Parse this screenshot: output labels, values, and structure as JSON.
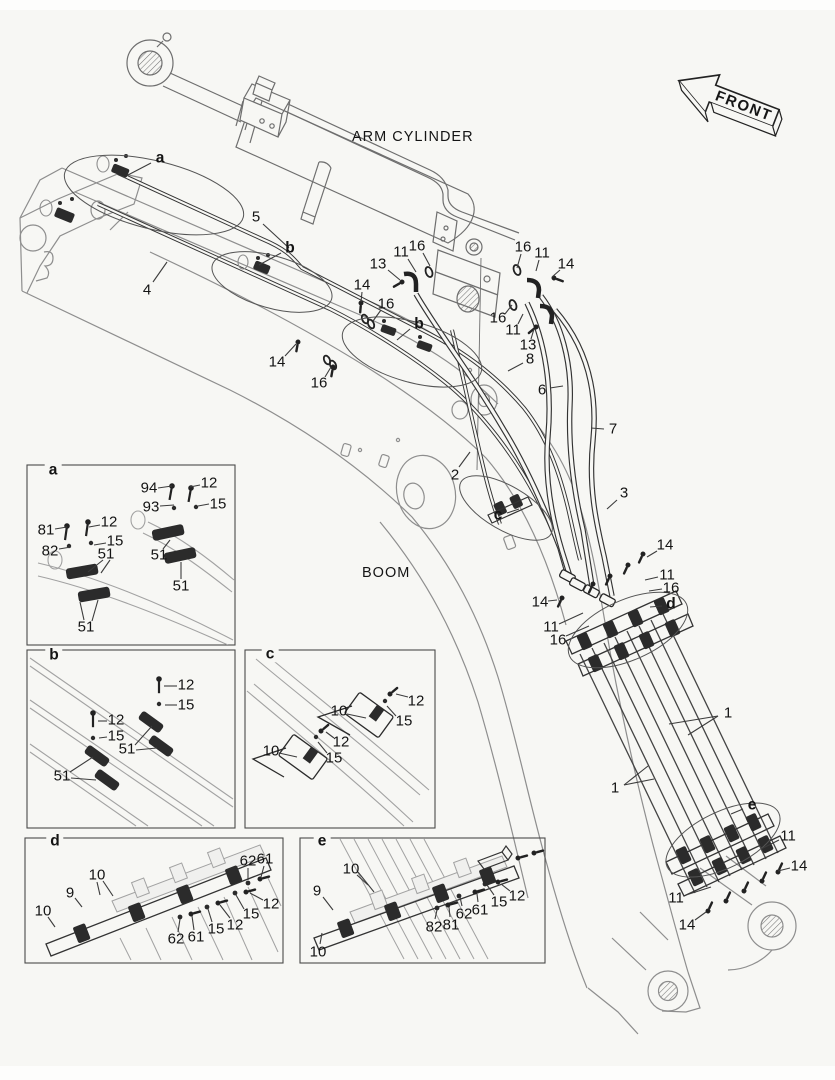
{
  "labels": {
    "arm_cylinder": "ARM CYLINDER",
    "boom": "BOOM",
    "front": "FRONT"
  },
  "colors": {
    "background": "#f7f7f4",
    "line_dark": "#262626",
    "line_structure": "#8e8e8e",
    "text": "#141414"
  },
  "main_callouts": [
    {
      "t": "a",
      "b": 1,
      "x": 160,
      "y": 158,
      "l": [
        [
          151,
          163,
          128,
          175
        ]
      ]
    },
    {
      "t": "5",
      "x": 256,
      "y": 217,
      "l": [
        [
          263,
          224,
          289,
          248
        ]
      ]
    },
    {
      "t": "b",
      "b": 1,
      "x": 290,
      "y": 248,
      "l": [
        [
          281,
          253,
          259,
          265
        ]
      ]
    },
    {
      "t": "4",
      "x": 147,
      "y": 290,
      "l": [
        [
          153,
          282,
          167,
          262
        ]
      ]
    },
    {
      "t": "13",
      "x": 378,
      "y": 264,
      "l": [
        [
          388,
          270,
          400,
          280
        ]
      ]
    },
    {
      "t": "11",
      "x": 401,
      "y": 252,
      "l": [
        [
          408,
          259,
          416,
          272
        ]
      ]
    },
    {
      "t": "16",
      "x": 417,
      "y": 246,
      "l": [
        [
          423,
          253,
          430,
          266
        ]
      ]
    },
    {
      "t": "14",
      "x": 362,
      "y": 285,
      "l": [
        [
          362,
          292,
          361,
          302
        ]
      ]
    },
    {
      "t": "16",
      "x": 386,
      "y": 304,
      "l": [
        [
          381,
          310,
          373,
          321
        ]
      ]
    },
    {
      "t": "b",
      "b": 1,
      "x": 419,
      "y": 324,
      "l": [
        [
          410,
          329,
          397,
          340
        ]
      ]
    },
    {
      "t": "14",
      "x": 277,
      "y": 362,
      "l": [
        [
          285,
          356,
          296,
          344
        ]
      ]
    },
    {
      "t": "16",
      "x": 319,
      "y": 383,
      "l": [
        [
          325,
          377,
          331,
          367
        ]
      ]
    },
    {
      "t": "16",
      "x": 523,
      "y": 247,
      "l": [
        [
          521,
          254,
          517,
          268
        ]
      ]
    },
    {
      "t": "11",
      "x": 542,
      "y": 253,
      "l": [
        [
          539,
          260,
          536,
          271
        ]
      ]
    },
    {
      "t": "14",
      "x": 566,
      "y": 264,
      "l": [
        [
          560,
          270,
          552,
          277
        ]
      ]
    },
    {
      "t": "16",
      "x": 498,
      "y": 318,
      "l": [
        [
          505,
          314,
          512,
          305
        ]
      ]
    },
    {
      "t": "11",
      "x": 513,
      "y": 330,
      "l": [
        [
          518,
          324,
          523,
          314
        ]
      ]
    },
    {
      "t": "13",
      "x": 528,
      "y": 345,
      "l": [
        [
          531,
          339,
          534,
          329
        ]
      ]
    },
    {
      "t": "8",
      "x": 530,
      "y": 359,
      "l": [
        [
          523,
          363,
          508,
          371
        ]
      ]
    },
    {
      "t": "6",
      "x": 542,
      "y": 390,
      "l": [
        [
          550,
          388,
          563,
          386
        ]
      ]
    },
    {
      "t": "7",
      "x": 613,
      "y": 429,
      "l": [
        [
          604,
          429,
          591,
          428
        ]
      ]
    },
    {
      "t": "2",
      "x": 455,
      "y": 475,
      "l": [
        [
          459,
          467,
          470,
          452
        ]
      ]
    },
    {
      "t": "3",
      "x": 624,
      "y": 493,
      "l": [
        [
          617,
          500,
          607,
          509
        ]
      ]
    },
    {
      "t": "c",
      "b": 1,
      "x": 498,
      "y": 515,
      "l": [
        [
          507,
          513,
          519,
          509
        ]
      ]
    },
    {
      "t": "14",
      "x": 665,
      "y": 545,
      "l": [
        [
          657,
          551,
          647,
          557
        ]
      ]
    },
    {
      "t": "11",
      "x": 667,
      "y": 575,
      "l": [
        [
          658,
          577,
          645,
          580
        ]
      ]
    },
    {
      "t": "16",
      "x": 671,
      "y": 588,
      "l": [
        [
          662,
          589,
          649,
          591
        ]
      ]
    },
    {
      "t": "d",
      "b": 1,
      "x": 671,
      "y": 604,
      "l": [
        [
          662,
          606,
          650,
          607
        ]
      ]
    },
    {
      "t": "14",
      "x": 540,
      "y": 602,
      "l": [
        [
          548,
          601,
          557,
          600
        ]
      ]
    },
    {
      "t": "11",
      "x": 551,
      "y": 627,
      "l": [
        [
          559,
          624,
          583,
          613
        ]
      ]
    },
    {
      "t": "16",
      "x": 558,
      "y": 640,
      "l": [
        [
          566,
          636,
          589,
          626
        ]
      ]
    },
    {
      "t": "1",
      "x": 728,
      "y": 713,
      "l": [
        [
          718,
          716,
          669,
          724
        ],
        [
          718,
          716,
          688,
          735
        ]
      ]
    },
    {
      "t": "1",
      "x": 615,
      "y": 788,
      "l": [
        [
          624,
          785,
          654,
          779
        ],
        [
          624,
          785,
          648,
          766
        ]
      ]
    },
    {
      "t": "e",
      "b": 1,
      "x": 752,
      "y": 805,
      "l": [
        [
          743,
          809,
          731,
          814
        ]
      ]
    },
    {
      "t": "11",
      "x": 788,
      "y": 836,
      "l": [
        [
          779,
          840,
          761,
          849
        ]
      ]
    },
    {
      "t": "14",
      "x": 799,
      "y": 866,
      "l": [
        [
          790,
          868,
          778,
          871
        ]
      ]
    },
    {
      "t": "11",
      "x": 676,
      "y": 898,
      "l": [
        [
          686,
          895,
          711,
          887
        ]
      ]
    },
    {
      "t": "14",
      "x": 687,
      "y": 925,
      "l": [
        [
          695,
          920,
          706,
          912
        ]
      ]
    }
  ],
  "detail_boxes": [
    {
      "label": "a",
      "lx": 53,
      "ly": 470,
      "callouts": [
        {
          "t": "94",
          "x": 149,
          "y": 488,
          "l": [
            [
              158,
              488,
              172,
              486
            ]
          ]
        },
        {
          "t": "12",
          "x": 209,
          "y": 483,
          "l": [
            [
              200,
              485,
              190,
              487
            ]
          ]
        },
        {
          "t": "93",
          "x": 151,
          "y": 507,
          "l": [
            [
              160,
              506,
              174,
              505
            ]
          ]
        },
        {
          "t": "15",
          "x": 218,
          "y": 504,
          "l": [
            [
              209,
              504,
              198,
              506
            ]
          ]
        },
        {
          "t": "81",
          "x": 46,
          "y": 530,
          "l": [
            [
              55,
              529,
              67,
              527
            ]
          ]
        },
        {
          "t": "12",
          "x": 109,
          "y": 522,
          "l": [
            [
              100,
              525,
              89,
              527
            ]
          ]
        },
        {
          "t": "82",
          "x": 50,
          "y": 551,
          "l": [
            [
              59,
              549,
              71,
              547
            ]
          ]
        },
        {
          "t": "15",
          "x": 115,
          "y": 541,
          "l": [
            [
              106,
              543,
              94,
              545
            ]
          ]
        },
        {
          "t": "51",
          "x": 106,
          "y": 554,
          "l": [
            [
              103,
              560,
              88,
              572
            ],
            [
              110,
              560,
              101,
              573
            ]
          ]
        },
        {
          "t": "51",
          "x": 159,
          "y": 555,
          "l": [
            [
              163,
              549,
              170,
              540
            ]
          ]
        },
        {
          "t": "51",
          "x": 181,
          "y": 586,
          "l": [
            [
              181,
              579,
              181,
              562
            ]
          ]
        },
        {
          "t": "51",
          "x": 86,
          "y": 627,
          "l": [
            [
              84,
              620,
              80,
              602
            ],
            [
              92,
              621,
              98,
              600
            ]
          ]
        }
      ]
    },
    {
      "label": "b",
      "lx": 54,
      "ly": 655,
      "callouts": [
        {
          "t": "12",
          "x": 186,
          "y": 685,
          "l": [
            [
              177,
              686,
              164,
              686
            ]
          ]
        },
        {
          "t": "15",
          "x": 186,
          "y": 705,
          "l": [
            [
              177,
              705,
              165,
              705
            ]
          ]
        },
        {
          "t": "12",
          "x": 116,
          "y": 720,
          "l": [
            [
              107,
              721,
              98,
              721
            ]
          ]
        },
        {
          "t": "15",
          "x": 116,
          "y": 736,
          "l": [
            [
              107,
              737,
              99,
              738
            ]
          ]
        },
        {
          "t": "51",
          "x": 127,
          "y": 749,
          "l": [
            [
              135,
              745,
              152,
              726
            ],
            [
              136,
              750,
              157,
              748
            ]
          ]
        },
        {
          "t": "51",
          "x": 62,
          "y": 776,
          "l": [
            [
              70,
              772,
              93,
              757
            ],
            [
              71,
              778,
              96,
              780
            ]
          ]
        }
      ]
    },
    {
      "label": "c",
      "lx": 270,
      "ly": 654,
      "callouts": [
        {
          "t": "12",
          "x": 416,
          "y": 701,
          "l": [
            [
              408,
              697,
              396,
              694
            ]
          ]
        },
        {
          "t": "15",
          "x": 404,
          "y": 721,
          "l": [
            [
              396,
              716,
              387,
              706
            ]
          ]
        },
        {
          "t": "10",
          "x": 339,
          "y": 711,
          "l": [
            [
              347,
              714,
              366,
              718
            ]
          ]
        },
        {
          "t": "12",
          "x": 341,
          "y": 742,
          "l": [
            [
              334,
              738,
              326,
              732
            ]
          ]
        },
        {
          "t": "15",
          "x": 334,
          "y": 758,
          "l": [
            [
              327,
              753,
              318,
              742
            ]
          ]
        },
        {
          "t": "10",
          "x": 271,
          "y": 751,
          "l": [
            [
              279,
              753,
              297,
              757
            ]
          ]
        }
      ]
    },
    {
      "label": "d",
      "lx": 55,
      "ly": 841,
      "callouts": [
        {
          "t": "10",
          "x": 97,
          "y": 875,
          "l": [
            [
              97,
              882,
              100,
              895
            ],
            [
              103,
              881,
              113,
              896
            ]
          ]
        },
        {
          "t": "9",
          "x": 70,
          "y": 893,
          "l": [
            [
              75,
              898,
              82,
              907
            ]
          ]
        },
        {
          "t": "10",
          "x": 43,
          "y": 911,
          "l": [
            [
              48,
              917,
              55,
              927
            ]
          ]
        },
        {
          "t": "62",
          "x": 248,
          "y": 861,
          "l": [
            [
              248,
              868,
              248,
              880
            ]
          ]
        },
        {
          "t": "61",
          "x": 265,
          "y": 859,
          "l": [
            [
              264,
              866,
              261,
              877
            ]
          ]
        },
        {
          "t": "12",
          "x": 271,
          "y": 904,
          "l": [
            [
              263,
              900,
              250,
              893
            ]
          ]
        },
        {
          "t": "15",
          "x": 251,
          "y": 914,
          "l": [
            [
              244,
              909,
              236,
              895
            ]
          ]
        },
        {
          "t": "62",
          "x": 176,
          "y": 939,
          "l": [
            [
              178,
              932,
              180,
              919
            ]
          ]
        },
        {
          "t": "61",
          "x": 196,
          "y": 937,
          "l": [
            [
              194,
              930,
              192,
              916
            ]
          ]
        },
        {
          "t": "15",
          "x": 216,
          "y": 929,
          "l": [
            [
              212,
              922,
              208,
              909
            ]
          ]
        },
        {
          "t": "12",
          "x": 235,
          "y": 925,
          "l": [
            [
              230,
              918,
              220,
              905
            ]
          ]
        }
      ]
    },
    {
      "label": "e",
      "lx": 322,
      "ly": 841,
      "callouts": [
        {
          "t": "10",
          "x": 351,
          "y": 869,
          "l": [
            [
              357,
              875,
              368,
              885
            ],
            [
              358,
              872,
              374,
              892
            ]
          ]
        },
        {
          "t": "9",
          "x": 317,
          "y": 891,
          "l": [
            [
              323,
              897,
              333,
              910
            ]
          ]
        },
        {
          "t": "10",
          "x": 318,
          "y": 952,
          "l": [
            [
              320,
              944,
              322,
              933
            ]
          ]
        },
        {
          "t": "82",
          "x": 434,
          "y": 927,
          "l": [
            [
              435,
              919,
              437,
              910
            ]
          ]
        },
        {
          "t": "81",
          "x": 451,
          "y": 925,
          "l": [
            [
              450,
              917,
              449,
              907
            ]
          ]
        },
        {
          "t": "62",
          "x": 464,
          "y": 914,
          "l": [
            [
              462,
              906,
              460,
              897
            ]
          ]
        },
        {
          "t": "61",
          "x": 480,
          "y": 910,
          "l": [
            [
              478,
              902,
              477,
              894
            ]
          ]
        },
        {
          "t": "15",
          "x": 499,
          "y": 902,
          "l": [
            [
              494,
              895,
              487,
              885
            ]
          ]
        },
        {
          "t": "12",
          "x": 517,
          "y": 896,
          "l": [
            [
              510,
              891,
              501,
              884
            ]
          ]
        }
      ]
    }
  ]
}
